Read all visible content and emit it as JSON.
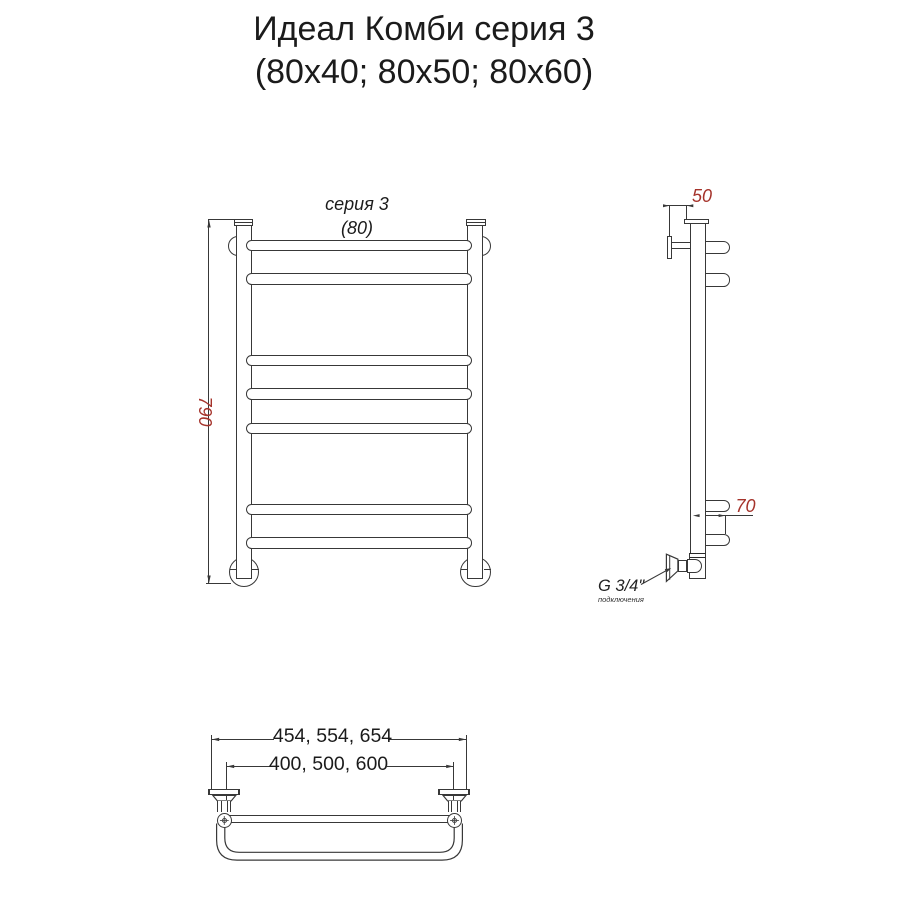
{
  "title": {
    "line1": "Идеал Комби серия 3",
    "line2": "(80x40; 80x50; 80x60)"
  },
  "front_view": {
    "series_label": "серия 3",
    "width_label": "(80)",
    "height_dim": "790"
  },
  "side_view": {
    "wall_offset_dim": "50",
    "bow_depth_dim": "70",
    "thread_label": "G 3/4\"",
    "thread_note": "подключения"
  },
  "top_view": {
    "overall_width_dim": "454, 554, 654",
    "axis_width_dim": "400, 500, 600"
  },
  "colors": {
    "line": "#383838",
    "dim_text": "#a5332b",
    "text": "#1b1b1b",
    "background": "#ffffff"
  }
}
